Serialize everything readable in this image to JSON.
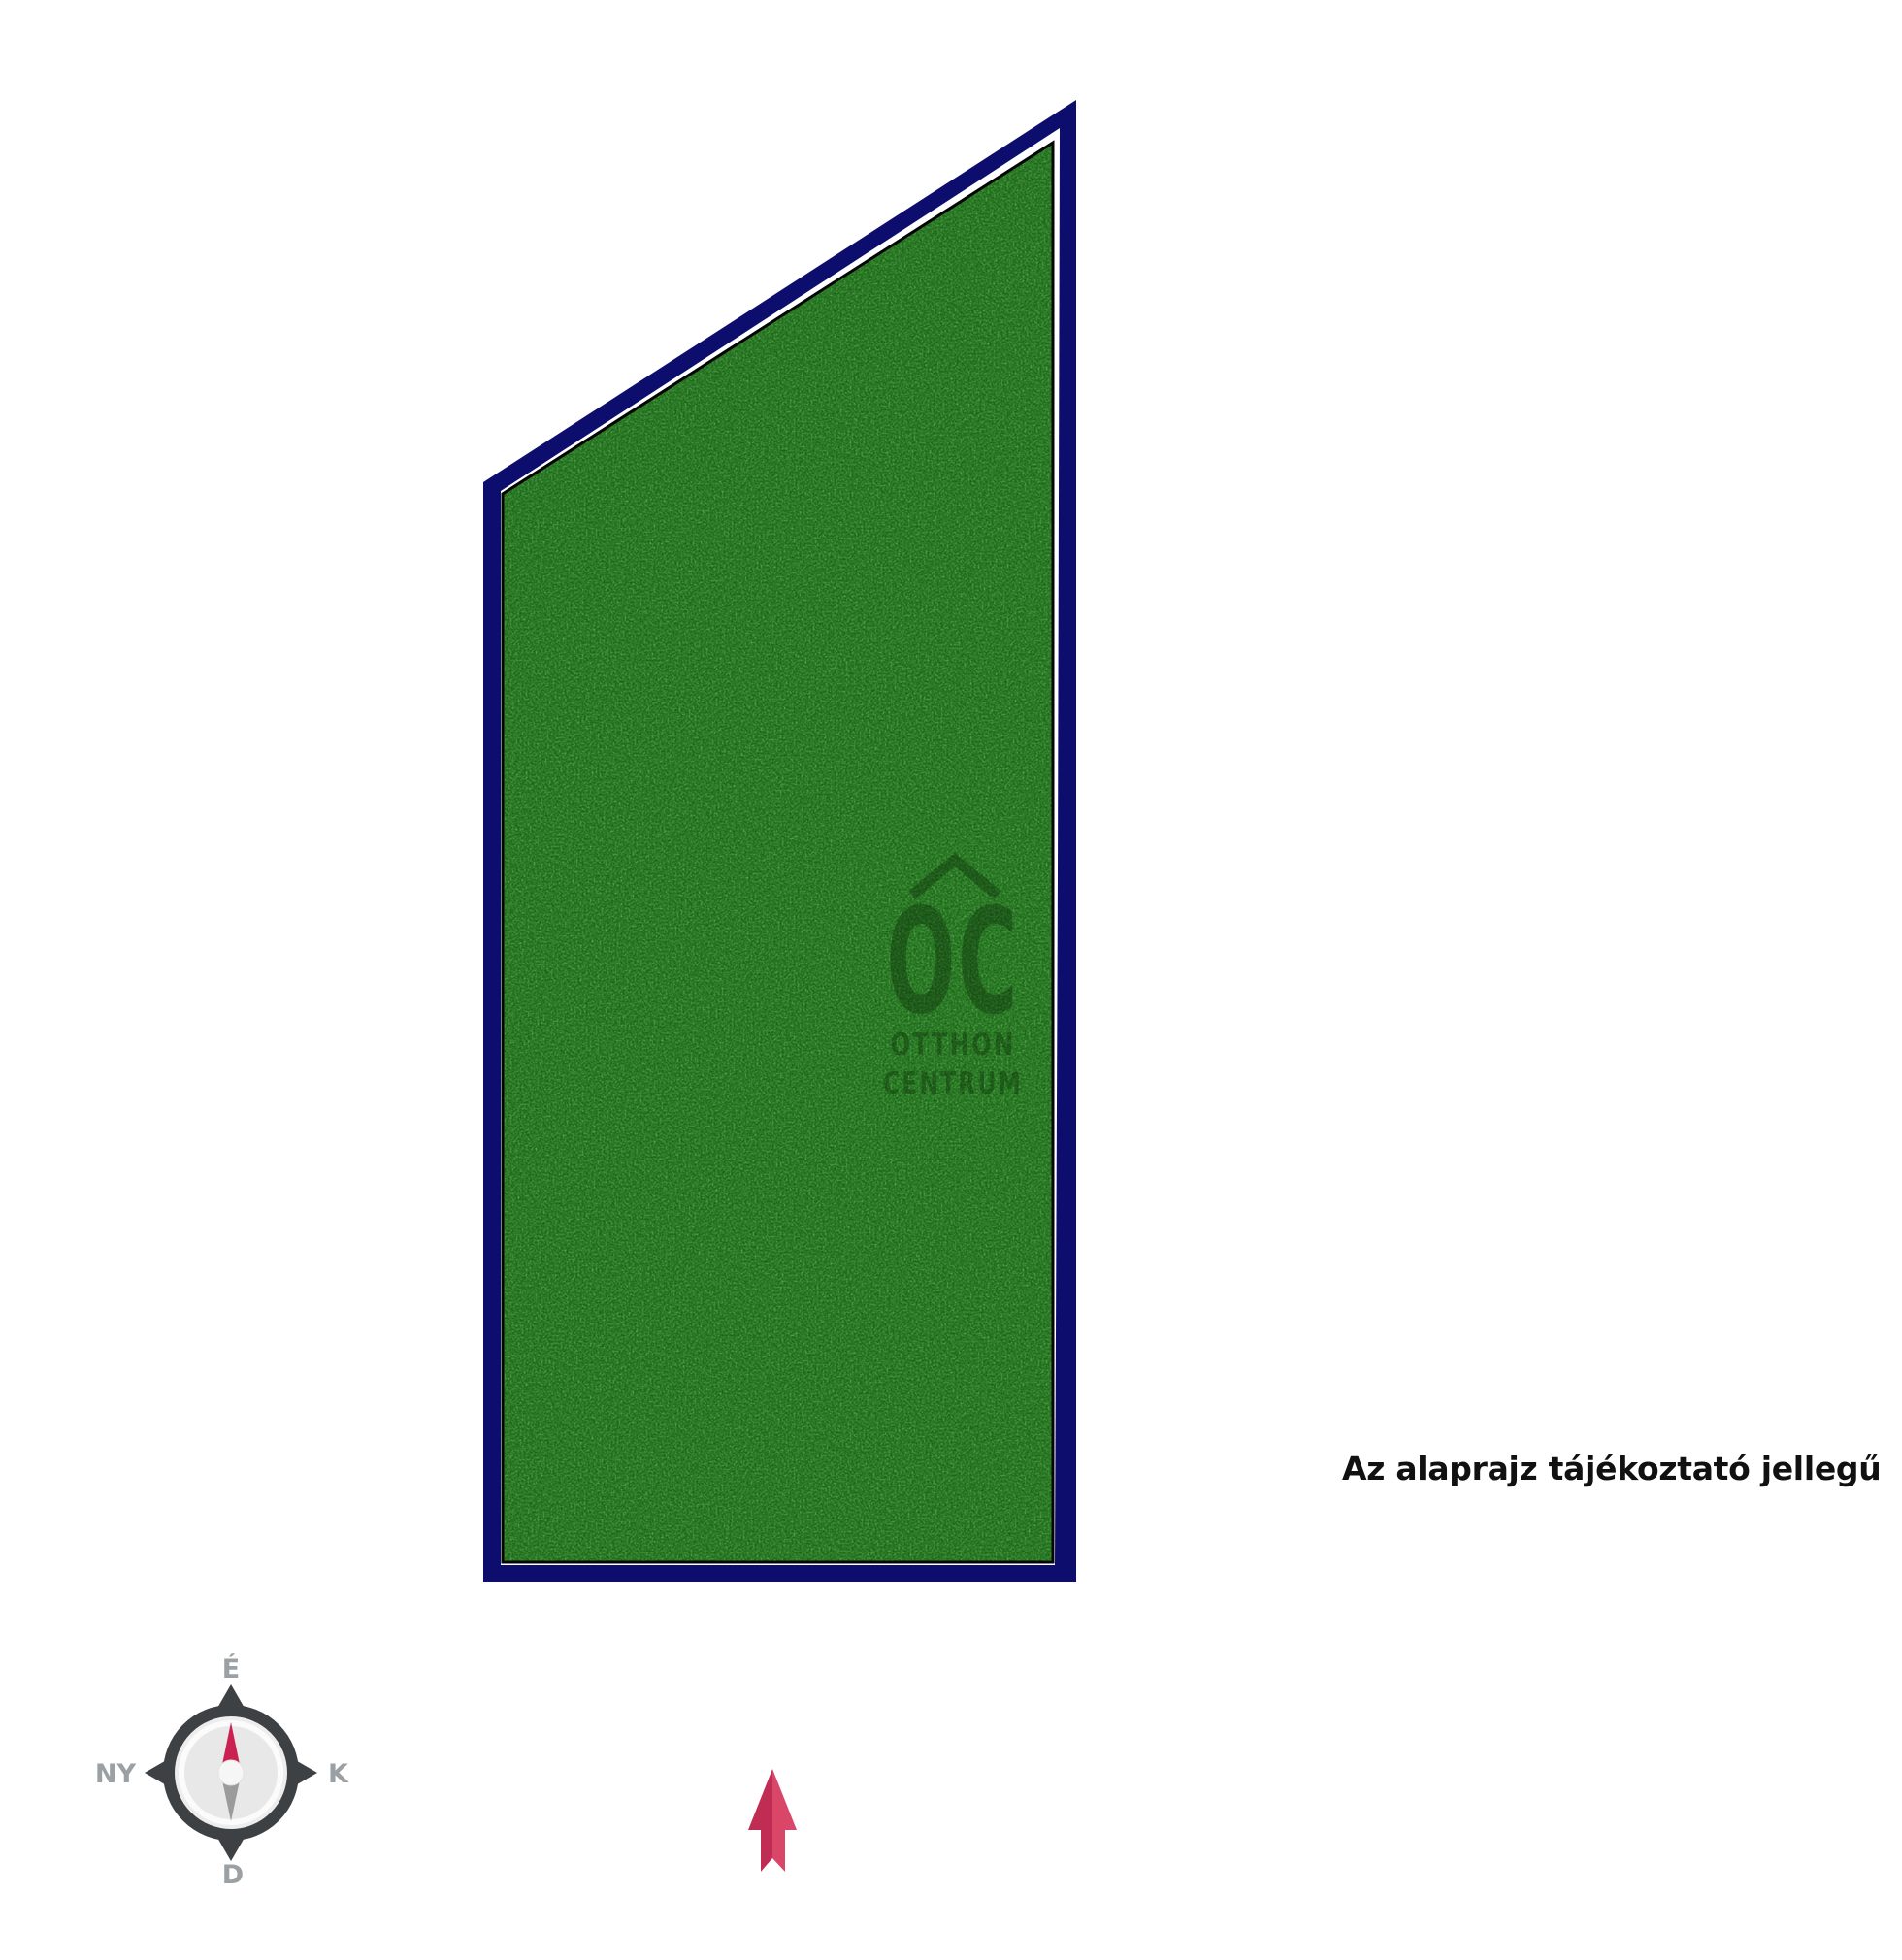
{
  "disclaimer": {
    "text": "Az alaprajz tájékoztató jellegű"
  },
  "watermark": {
    "logo": "OC",
    "line1": "OTTHON",
    "line2": "CENTRUM"
  },
  "compass": {
    "north": "É",
    "south": "D",
    "east": "K",
    "west": "NY"
  },
  "colors": {
    "plot_border": "#0d0d6e",
    "plot_gap": "#ffffff",
    "plot_fill": "#2b7d26",
    "plot_outline": "#050505",
    "watermark_ink": "#0c2b08",
    "compass_ring": "#3e4144",
    "compass_face": "#ededed",
    "compass_face_inner": "#e8e8e8",
    "compass_label": "#9aa0a3",
    "needle_north": "#cb2150",
    "needle_south": "#9b9b9b",
    "needle_hub": "#f6f6f6",
    "arrow_dark": "#bf2d55",
    "arrow_light": "#da4668"
  }
}
